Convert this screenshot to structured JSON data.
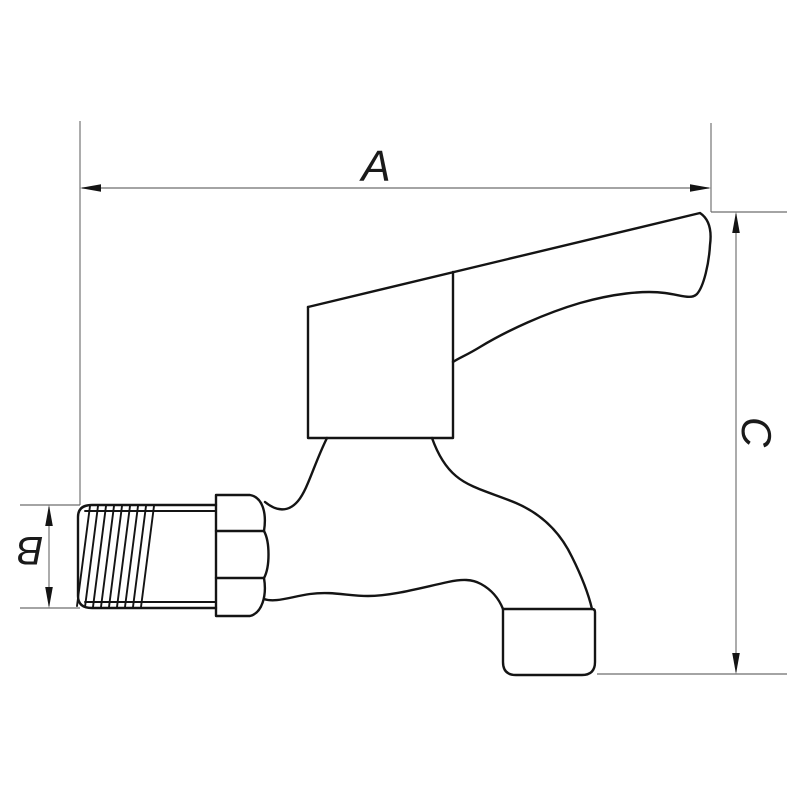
{
  "page": {
    "background": "#ffffff"
  },
  "drawing": {
    "subject": "bibcock-tap-side-view-technical-drawing",
    "labels": {
      "a": "A",
      "b": "B",
      "c": "C"
    },
    "dimensions": [
      {
        "label": "A",
        "orientation": "horizontal",
        "position": "top"
      },
      {
        "label": "B",
        "orientation": "vertical",
        "position": "left"
      },
      {
        "label": "C",
        "orientation": "vertical",
        "position": "right"
      }
    ],
    "colors": {
      "background": "#ffffff",
      "outline": "#141414",
      "dimension_lines": "#6e6e6e",
      "label_text": "#1a1a1a"
    }
  }
}
